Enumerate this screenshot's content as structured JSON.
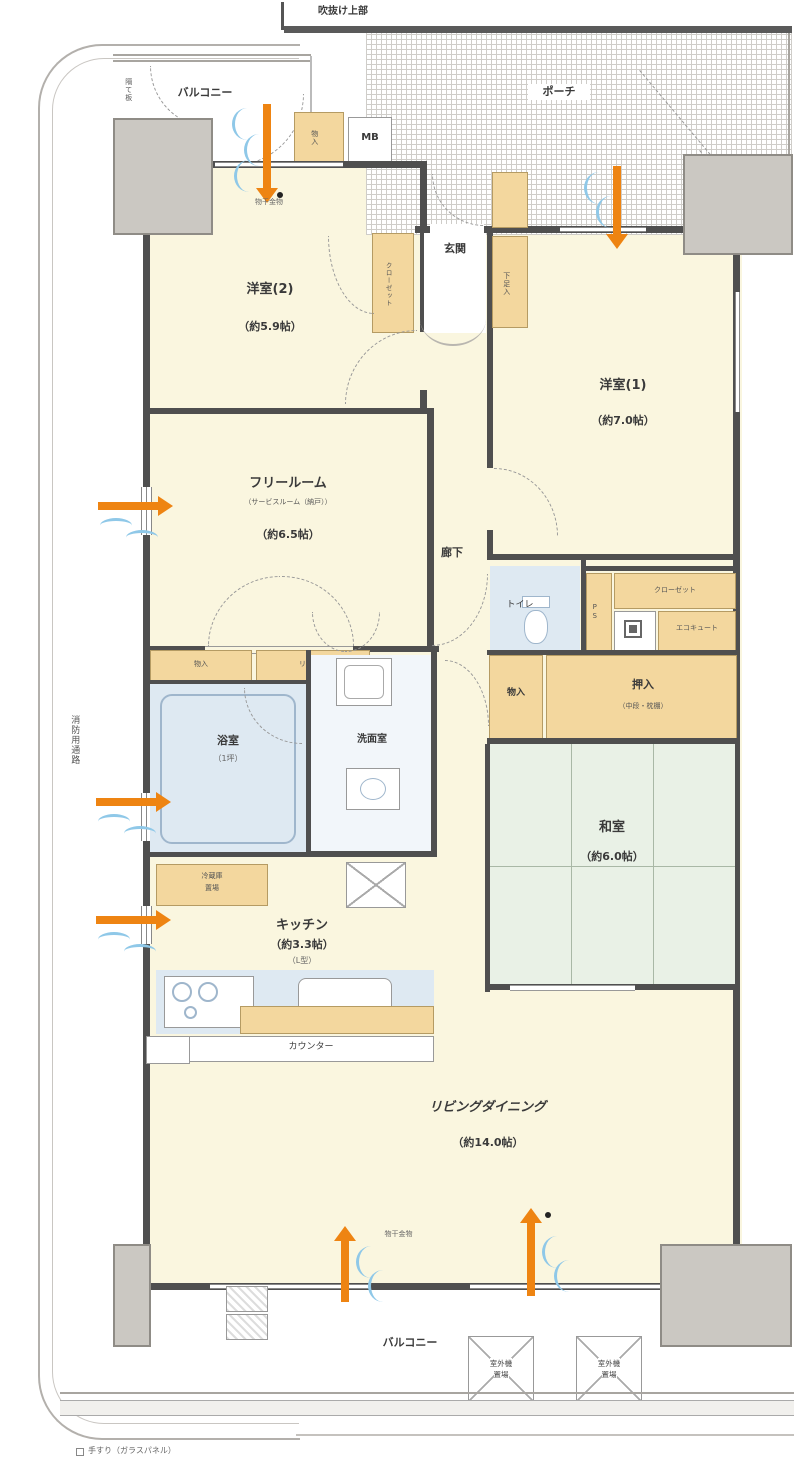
{
  "colors": {
    "room_cream": "#FAF6DF",
    "storage_tan": "#F3D79E",
    "water_blue": "#DEE9F2",
    "tatami_green": "#E9F1E6",
    "wall_gray": "#4F4F4F",
    "pillar_gray": "#CBC8C2",
    "airflow_orange": "#EE8412",
    "airflow_blue": "#8FC8E8"
  },
  "labels": {
    "void_upper": "吹抜け上部",
    "porch": "ポーチ",
    "balcony_top": "バルコニー",
    "balcony_bottom": "バルコニー",
    "partition": "隔て板",
    "storage_top": "物入",
    "mb_top": "MB",
    "entrance": "玄関",
    "shoe": "下足入",
    "western2_name": "洋室(2)",
    "western2_size": "（約5.9帖）",
    "closet2": "クローゼット",
    "western1_name": "洋室(1)",
    "western1_size": "（約7.0帖）",
    "free_name": "フリールーム",
    "free_note": "（サービスルーム（納戸））",
    "free_size": "（約6.5帖）",
    "hall": "廊下",
    "toilet": "トイレ",
    "ps": "PS",
    "closet1": "クローゼット",
    "ecocute": "エコキュート",
    "oshiire": "押入",
    "oshiire_note": "（中段・枕棚）",
    "monoire": "物入",
    "washitsu_name": "和室",
    "washitsu_size": "（約6.0帖）",
    "bath_name": "浴室",
    "bath_size": "（1坪）",
    "wash_name": "洗面室",
    "linen_left": "物入",
    "linen_right": "リネン庫",
    "fridge_l1": "冷蔵庫",
    "fridge_l2": "置場",
    "kitchen_name": "キッチン",
    "kitchen_size": "（約3.3帖）",
    "kitchen_note": "（L型）",
    "counter": "カウンター",
    "living_name": "リビングダイニング",
    "living_size": "（約14.0帖）",
    "fire_route": "消防用通路",
    "laundry_top": "物干金物",
    "laundry_bottom": "物干金物",
    "outdoor_l1": "室外機",
    "outdoor_l2": "置場",
    "handrail_note": "手すり（ガラスパネル）"
  }
}
